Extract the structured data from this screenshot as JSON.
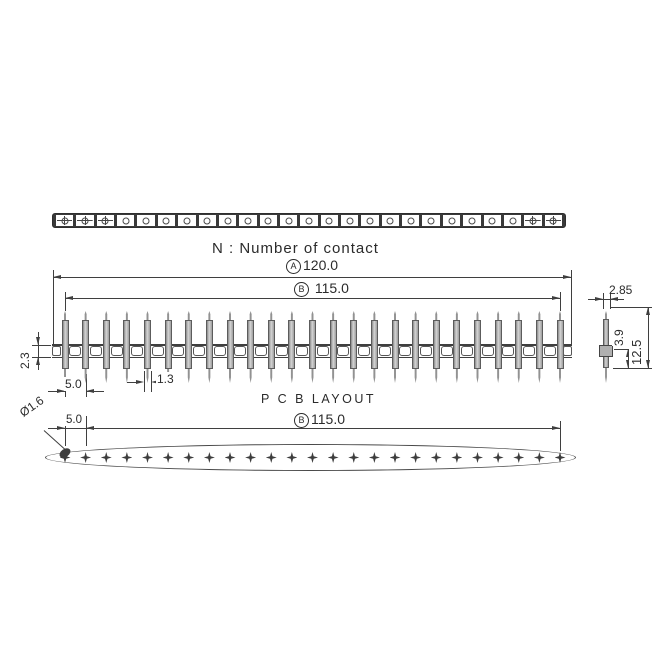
{
  "title_note": "N : Number of contact",
  "pcb_section_label": "P C B  LAYOUT",
  "dimensions": {
    "overall_length": {
      "label": "A",
      "value": "120.0"
    },
    "contact_span": {
      "label": "B",
      "value": "115.0"
    },
    "pcb_span": {
      "label": "B",
      "value": "115.0"
    },
    "pin_pitch": "5.0",
    "pcb_hole_pitch": "5.0",
    "pin_thickness": "1.3",
    "body_height": "2.3",
    "detail_pin_width": "2.85",
    "pin_tail_length": "3.9",
    "pin_total_length": "12.5",
    "hole_diameter": "Ø1.6"
  },
  "counts": {
    "top_cells": 25,
    "star_cells": [
      0,
      1,
      2,
      23,
      24
    ],
    "side_pins": 25,
    "band_links": 24,
    "pcb_holes": 25
  },
  "colors": {
    "line": "#3f3f3f",
    "text": "#2b2b2b",
    "pin_fill": "#d4d4d4",
    "pin_edge": "#5c5c5c",
    "hole": "#3d3d3d",
    "background": "#ffffff"
  }
}
